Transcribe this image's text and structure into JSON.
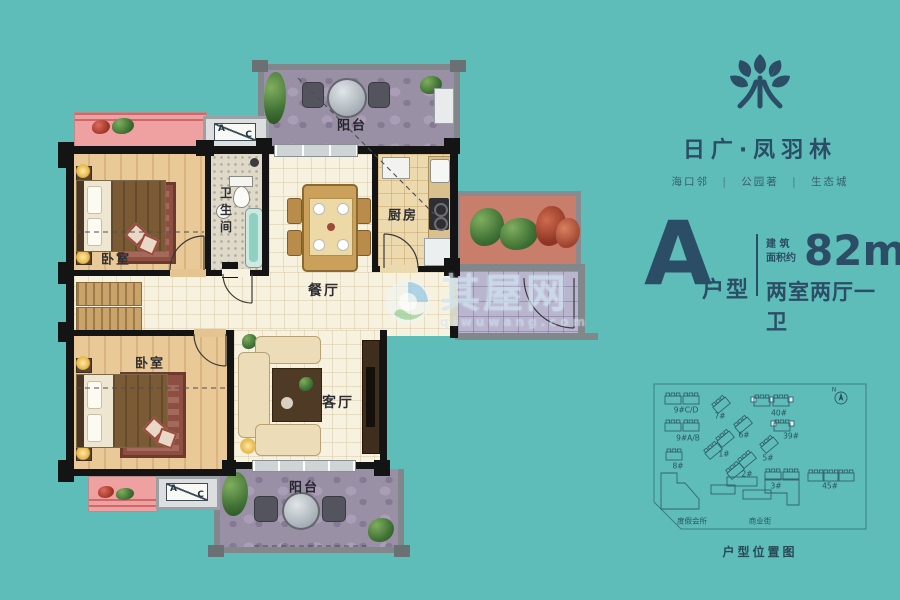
{
  "colors": {
    "background": "#5fbdb9",
    "navy": "#2b4d66",
    "wall_black": "#141414",
    "wall_grey": "#82878c",
    "pink_ledge": "#efa0a0",
    "stone_purple": "#9a90a6"
  },
  "brand": {
    "title": "日广·凤羽林",
    "subtitle_parts": [
      "海口邻",
      "公园著",
      "生态城"
    ],
    "separator": "|"
  },
  "unit_info": {
    "type_letter": "A",
    "type_suffix": "户型",
    "area_caption_line1": "建 筑",
    "area_caption_line2": "面积约",
    "area_value": "82m",
    "area_superscript": "2",
    "rooms_summary": "两室两厅一卫"
  },
  "floor_plan": {
    "labels": {
      "balcony_top": "阳台",
      "bedroom_top": "卧室",
      "bathroom": "卫生间",
      "dining": "餐厅",
      "kitchen": "厨房",
      "bedroom_bottom": "卧室",
      "living": "客厅",
      "balcony_bottom": "阳台"
    },
    "ac_sign": {
      "left": "A",
      "right": "C"
    }
  },
  "watermark": {
    "text": "其屋网",
    "subtext": "qiwuwang.com"
  },
  "site_plan": {
    "caption": "户型位置图",
    "compass_label": "N",
    "buildings": [
      {
        "label": "9#C/D"
      },
      {
        "label": "7#"
      },
      {
        "label": "40#"
      },
      {
        "label": "9#A/B"
      },
      {
        "label": "6#"
      },
      {
        "label": "39#"
      },
      {
        "label": "1#"
      },
      {
        "label": "5#"
      },
      {
        "label": "8#"
      },
      {
        "label": "2#"
      },
      {
        "label": "3#"
      },
      {
        "label": "45#"
      },
      {
        "label": "度假会所"
      },
      {
        "label": "商业街"
      }
    ]
  }
}
